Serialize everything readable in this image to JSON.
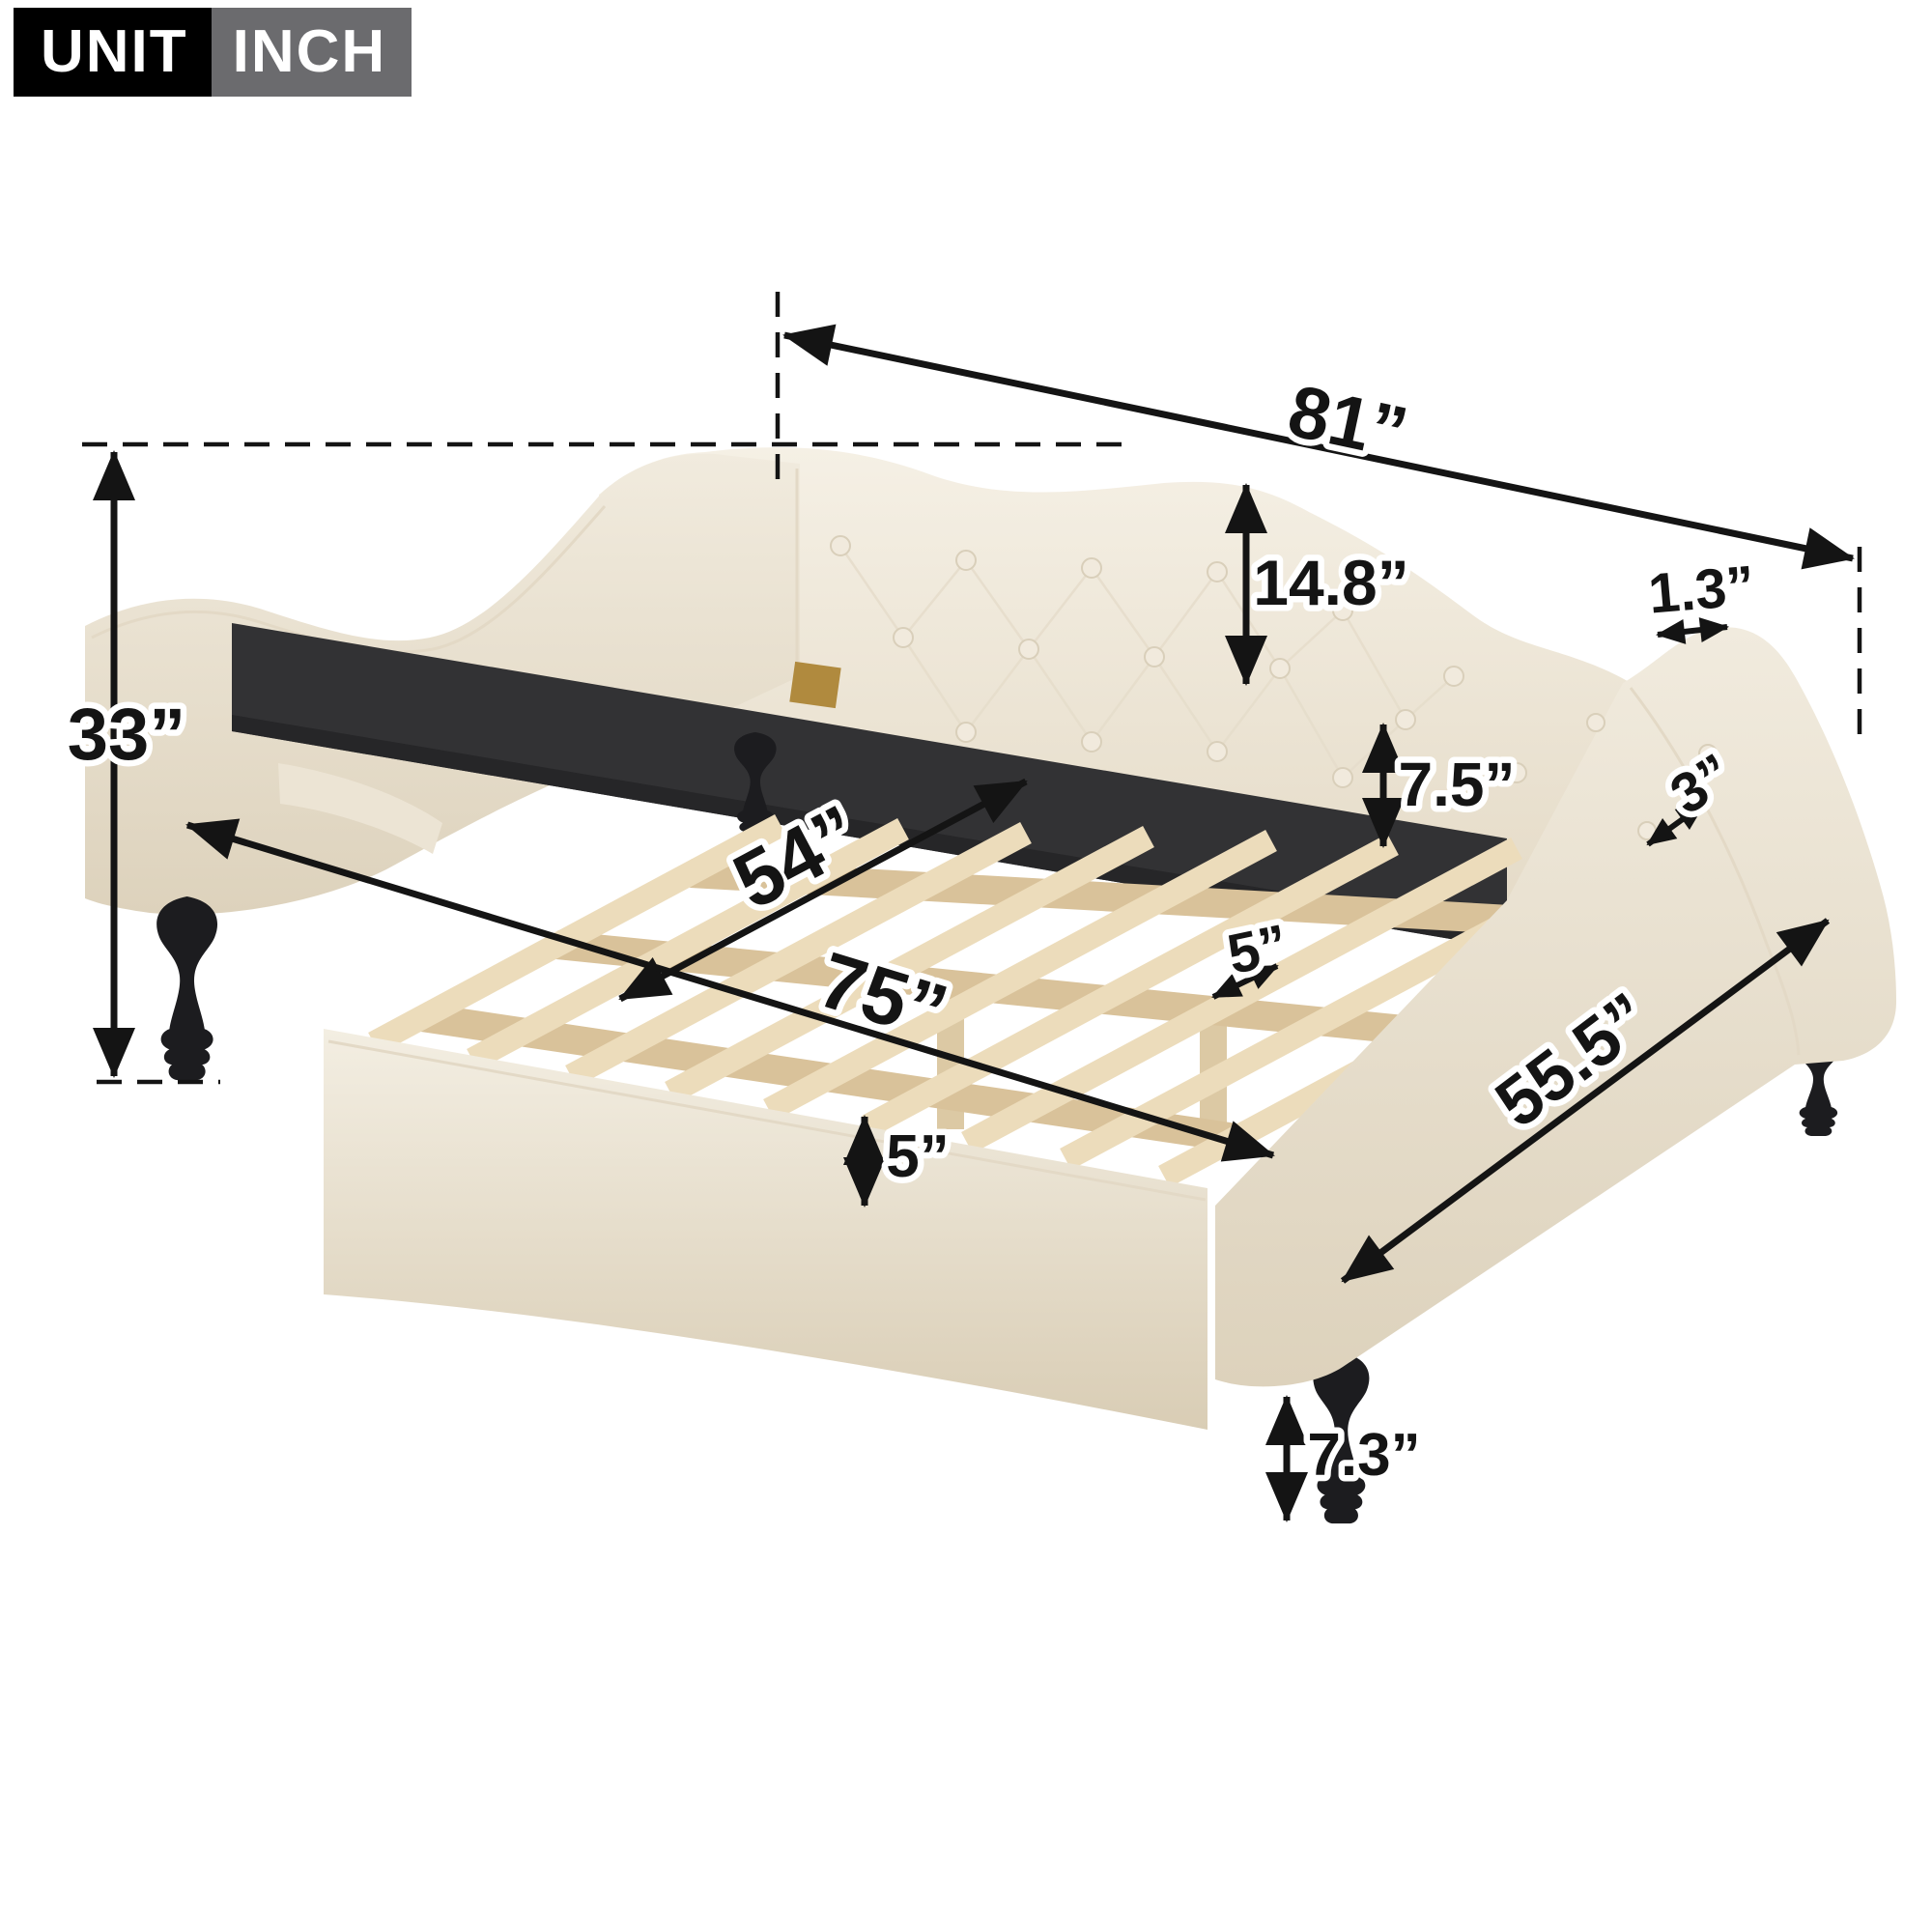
{
  "badge": {
    "unit_label": "UNIT",
    "unit_name": "INCH"
  },
  "dimensions": {
    "overall_length": "81”",
    "overall_height": "33”",
    "backrest_height": "14.8”",
    "back_top_edge_width": "1.3”",
    "slat_to_rail_height": "7.5”",
    "arm_top_edge_width": "3”",
    "inner_width": "54”",
    "inner_length": "75”",
    "slat_width": "5”",
    "front_rail_height": "5”",
    "overall_depth": "55.5”",
    "leg_height": "7.3”"
  },
  "colors": {
    "badge_black": "#000000",
    "badge_gray": "#6b6b6e",
    "fabric_light": "#f2ecdf",
    "fabric_shadow": "#ded4c0",
    "inner_rail_dark": "#323234",
    "wood_slat": "#ecdcbb",
    "wood_batten": "#d9c29a",
    "leg_black": "#1c1c1f",
    "bracket_brass": "#b08a3e",
    "annotation": "#141414"
  }
}
